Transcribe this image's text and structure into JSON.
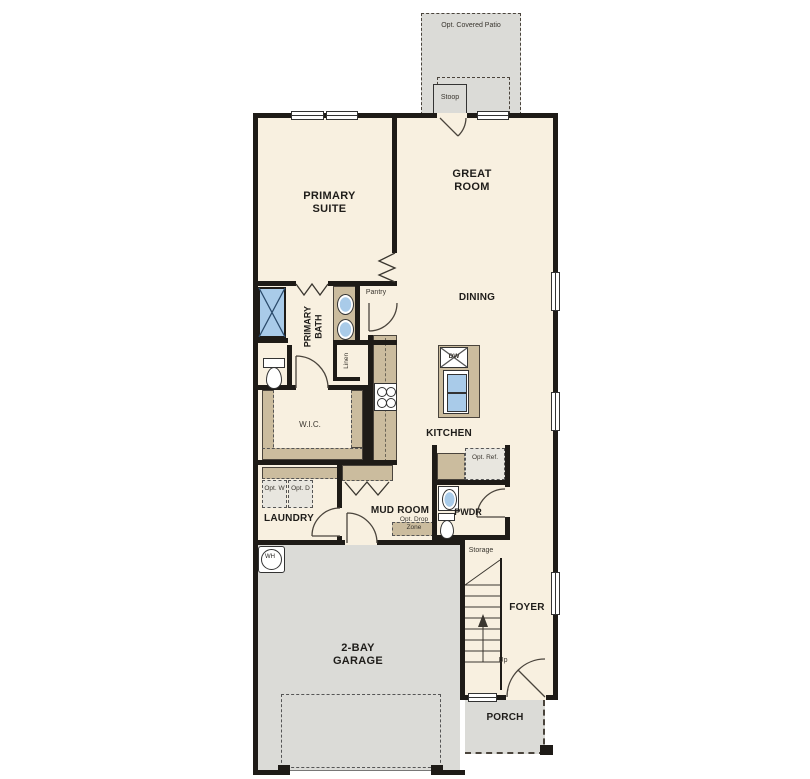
{
  "floor_plan": {
    "exterior": {
      "patio": "Opt. Covered Patio",
      "stoop": "Stoop",
      "porch": "PORCH"
    },
    "rooms": {
      "primary_suite": "PRIMARY SUITE",
      "great_room": "GREAT ROOM",
      "dining": "DINING",
      "kitchen": "KITCHEN",
      "primary_bath": "PRIMARY BATH",
      "laundry": "LAUNDRY",
      "mud_room": "MUD ROOM",
      "pwdr": "PWDR",
      "foyer": "FOYER",
      "garage": "2-BAY GARAGE"
    },
    "closets": {
      "pantry": "Pantry",
      "linen": "Linen",
      "wic": "W.I.C.",
      "storage": "Storage"
    },
    "fixtures": {
      "dishwasher": "DW",
      "water_heater": "WH"
    },
    "optional": {
      "washer": "Opt. W",
      "dryer": "Opt. D",
      "drop_zone": "Opt. Drop Zone",
      "refrigerator": "Opt. Ref."
    },
    "stairs": {
      "direction": "Up"
    },
    "colors": {
      "wall": "#1e1b17",
      "interior_floor": "#f8f0e0",
      "hard_surface": "#dbdbd7",
      "cabinetry": "#cbbc9e",
      "plumbing": "#a9cbe9"
    }
  }
}
